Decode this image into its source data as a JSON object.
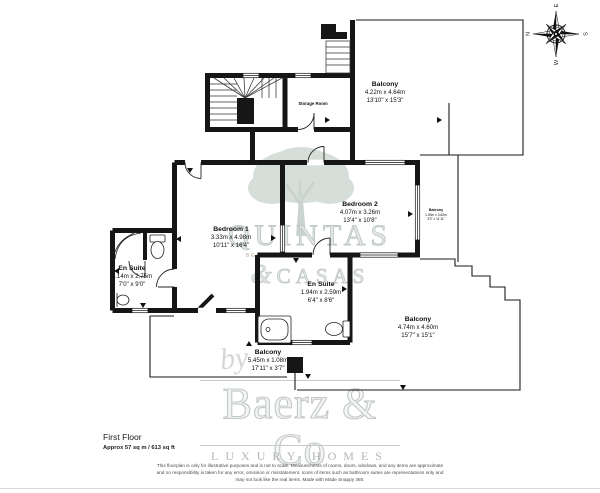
{
  "rooms": [
    {
      "name": "Balcony",
      "metric": "4.22m x 4.64m",
      "imperial": "13'10\" x 15'3\""
    },
    {
      "name": "Storage Room"
    },
    {
      "name": "Bedroom 1",
      "metric": "3.33m x 4.98m",
      "imperial": "10'11\" x 16'4\""
    },
    {
      "name": "Bedroom 2",
      "metric": "4.07m x 3.26m",
      "imperial": "13'4\" x 10'8\""
    },
    {
      "name": "En Suite",
      "metric": "2.14m x 2.75m",
      "imperial": "7'0\" x 9'0\""
    },
    {
      "name": "En Suite",
      "metric": "1.94m x 2.59m",
      "imperial": "6'4\" x 8'6\""
    },
    {
      "name": "Balcony",
      "metric": "1.00m x 3.62m",
      "imperial": "3'3\" x 11'11\""
    },
    {
      "name": "Balcony",
      "metric": "4.74m x 4.60m",
      "imperial": "15'7\" x 15'1\""
    },
    {
      "name": "Balcony",
      "metric": "5.45m x 1.08m",
      "imperial": "17'11\" x 3'7\""
    }
  ],
  "compass": {
    "north": "N",
    "east": "E",
    "south": "S",
    "west": "W"
  },
  "footer": {
    "floor": "First Floor",
    "area": "Approx 57 sq m / 613 sq ft"
  },
  "disclaimer": {
    "line1": "This floorplan is only for illustrative purposes and is not to scale. Measurements of rooms, doors, windows, and any items are approximate",
    "line2": "and no responsibility is taken for any error, omission or misstatement. Icons of items such as bathroom suites are representations only and",
    "line3": "may not look like the real items. Made with Made Snappy 360."
  },
  "watermark": {
    "agency_name_top": "QUINTAS",
    "agency_amp": "&",
    "agency_name_bottom": "CASAS",
    "agency_tagline": "BESPOKE PROPERTY SERVICES",
    "script_by": "by",
    "brand": "Baerz & Co",
    "brand_tagline": "LUXURY HOMES"
  },
  "colors": {
    "wall": "#161616",
    "line": "#222222",
    "watermark_gray": "#c7cbcb",
    "tagline_tan": "#bdb2a0"
  }
}
